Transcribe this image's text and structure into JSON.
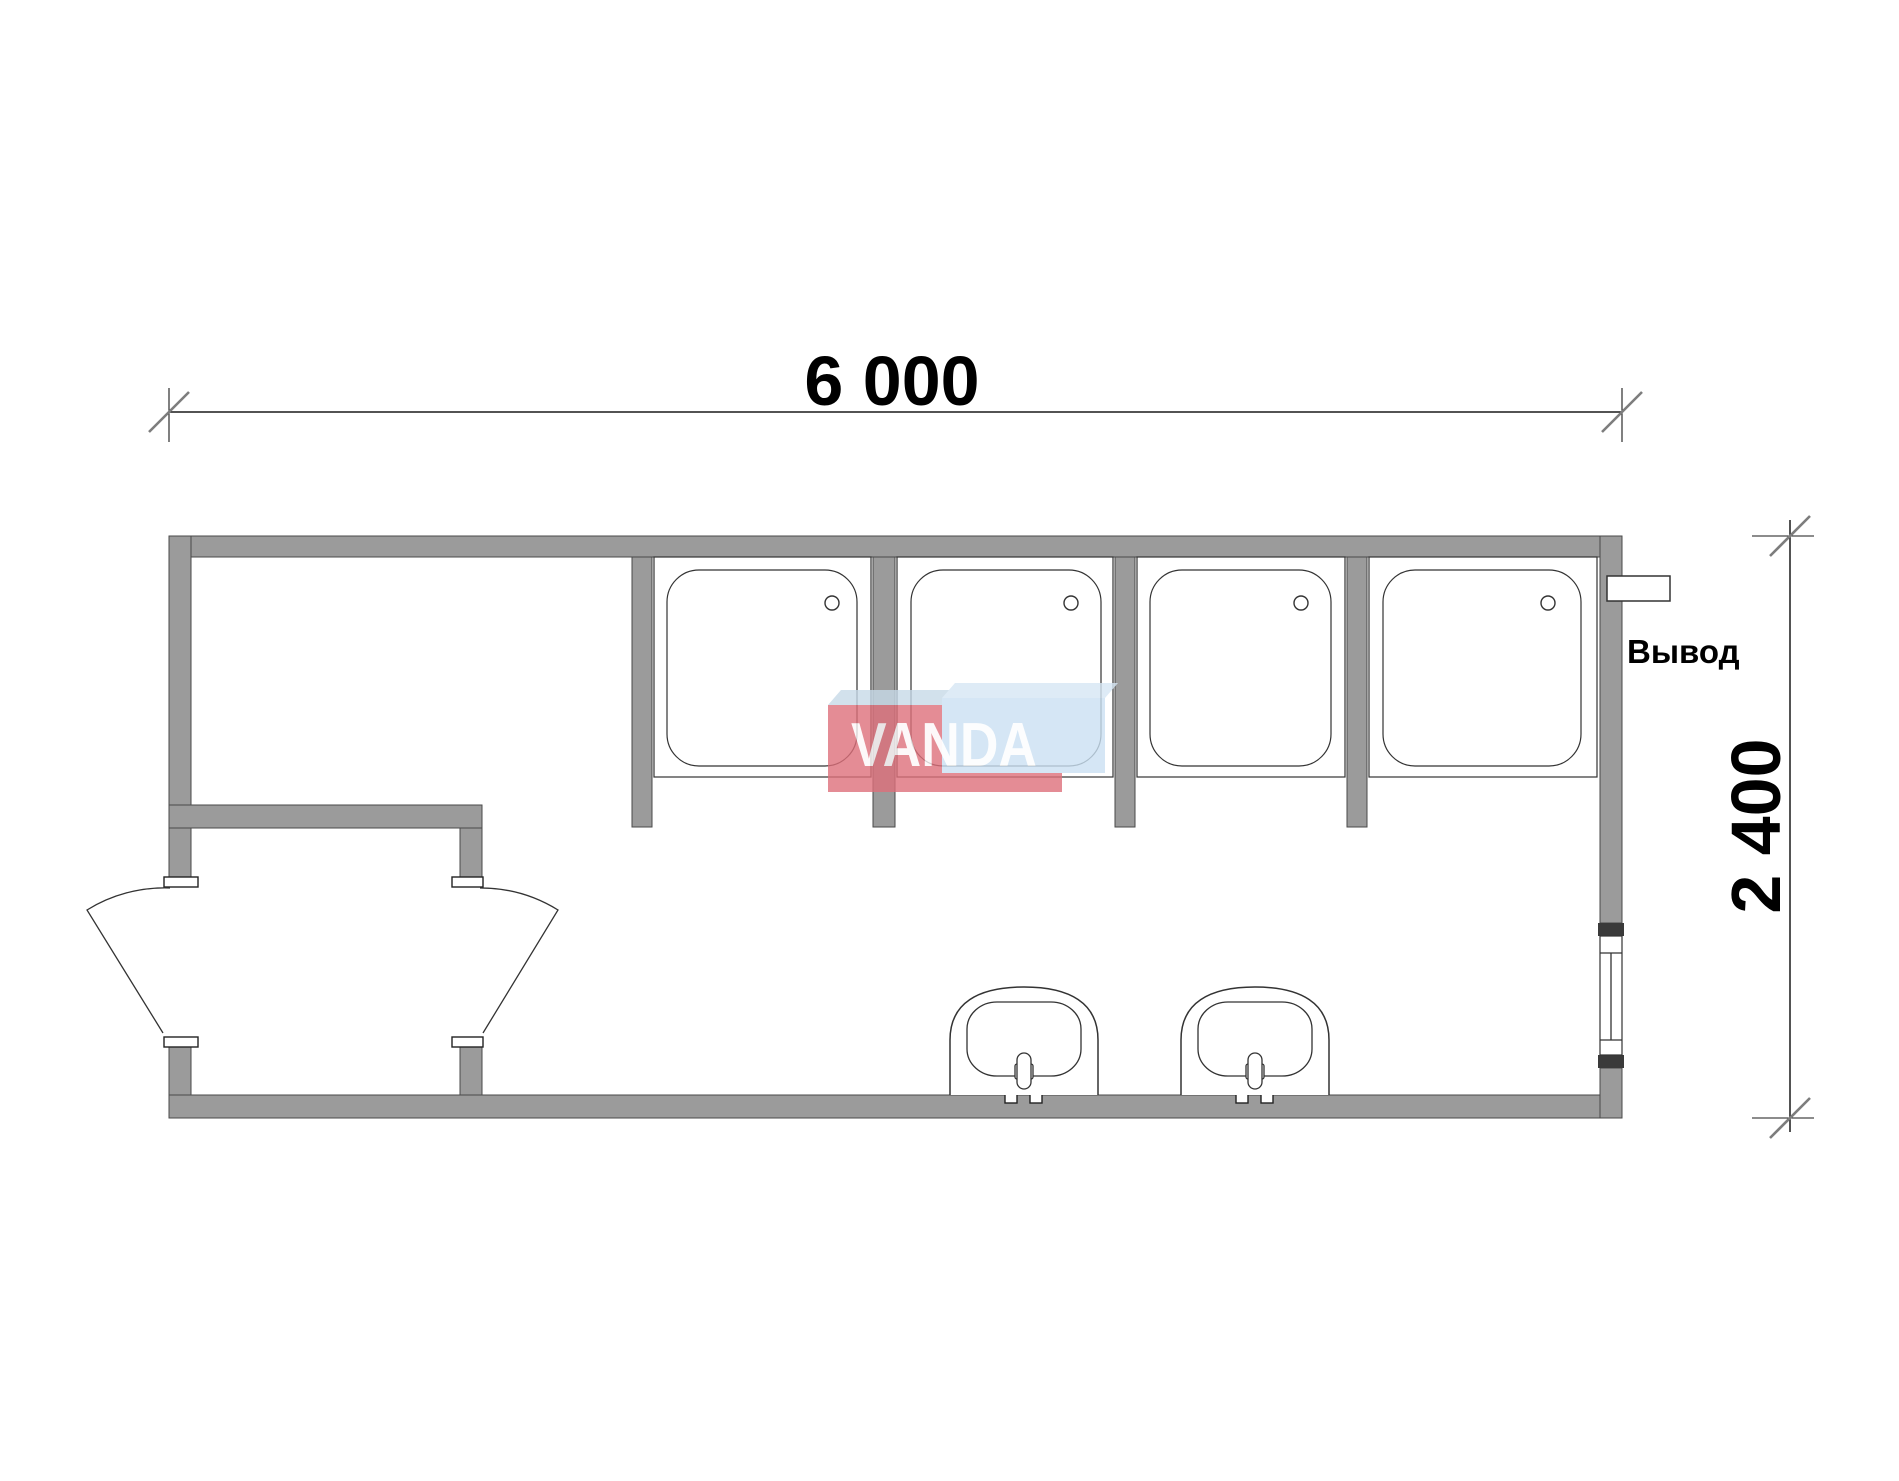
{
  "labels": {
    "width_dimension": "6 000",
    "height_dimension": "2 400",
    "outlet": "Вывод",
    "watermark": "VANDA"
  },
  "colors": {
    "background": "#ffffff",
    "wall_fill": "#9b9b9b",
    "wall_stroke": "#4a4a4a",
    "drawing_line": "#333333",
    "tick_gray": "#7d7d7d",
    "logo_pink": "#de707b",
    "logo_light_blue": "#cbe1f3",
    "logo_top_face_blue": "#d6e7f5"
  },
  "fixtures": {
    "shower_trays": 4,
    "washbasins": 2,
    "door_leaves": 2,
    "windows": 1,
    "outlets": 1
  }
}
